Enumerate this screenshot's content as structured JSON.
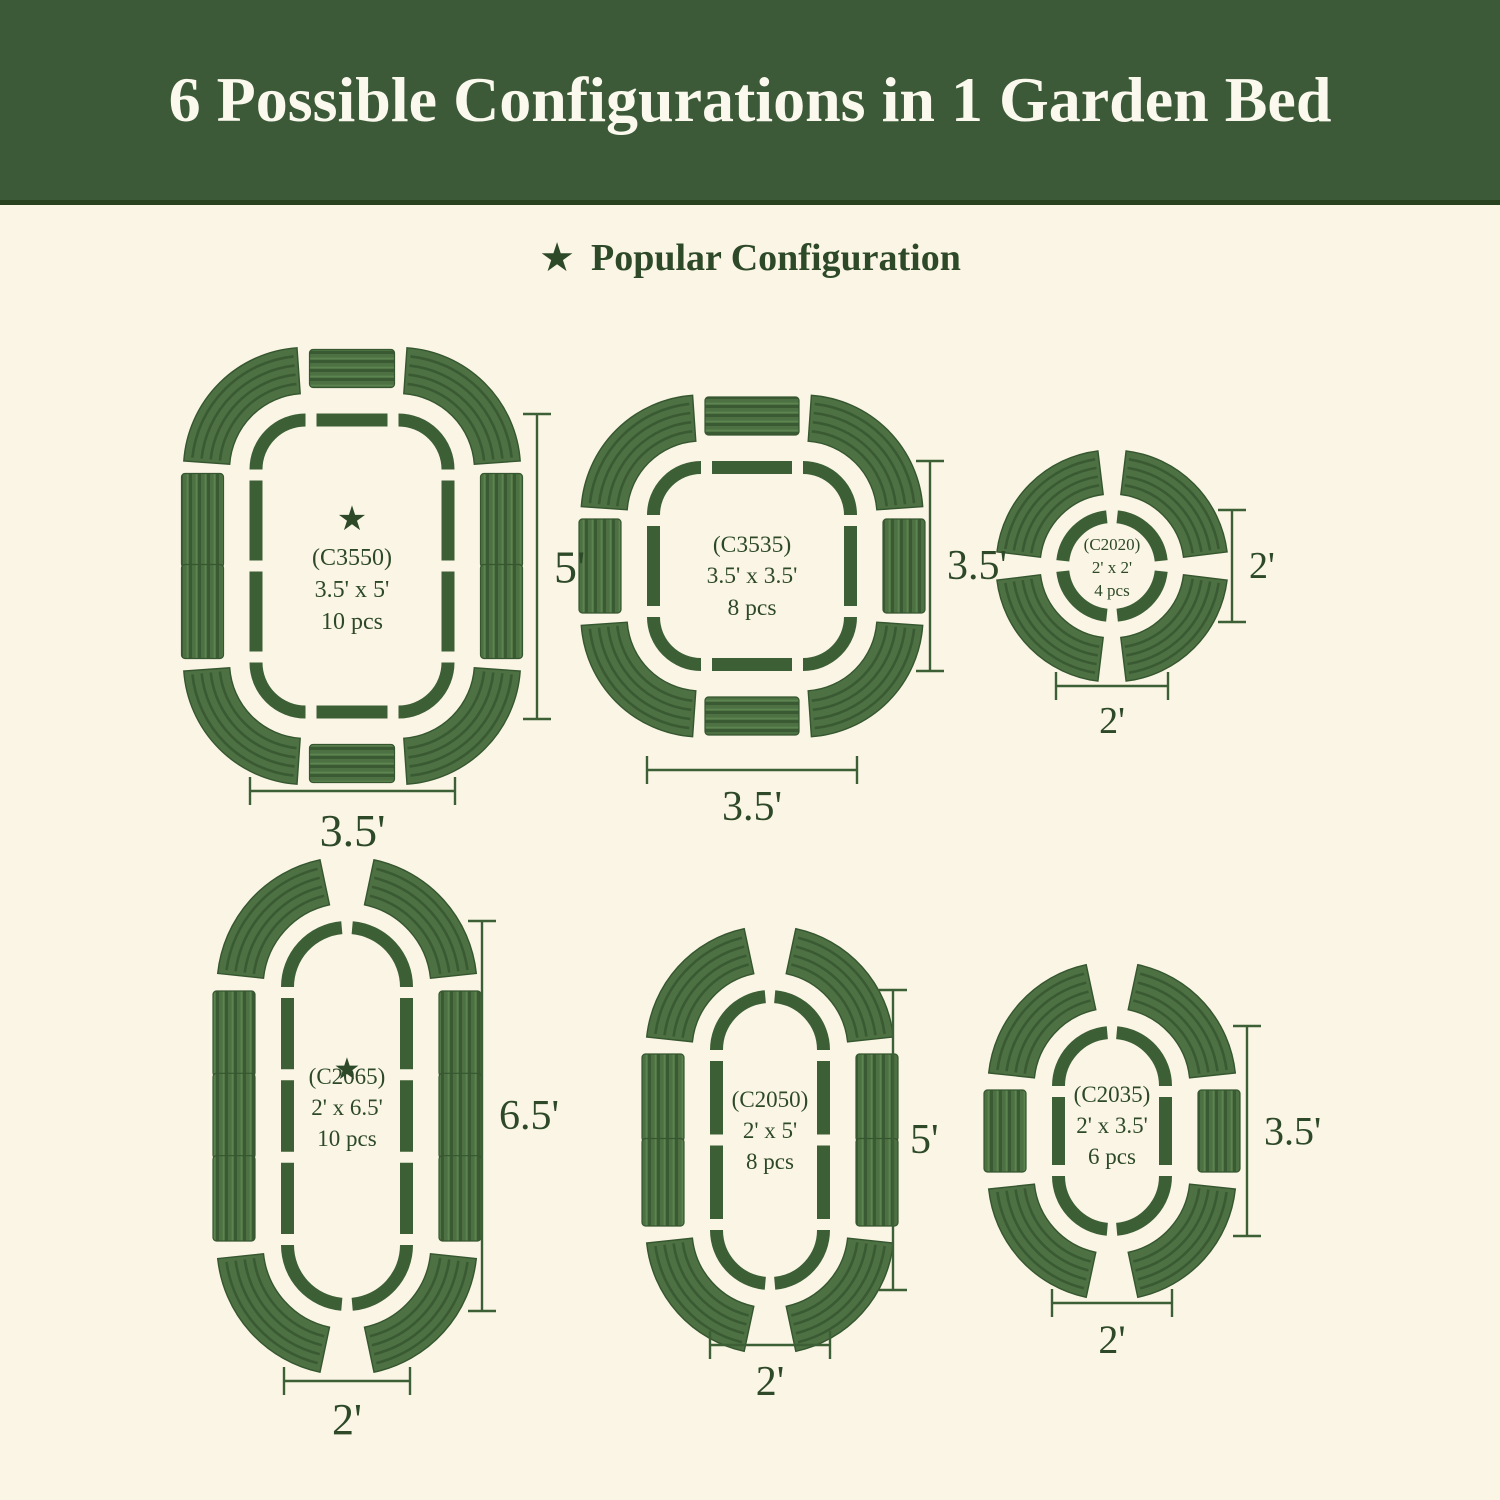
{
  "header": {
    "title": "6 Possible Configurations in 1 Garden Bed"
  },
  "legend": {
    "label": "Popular Configuration"
  },
  "icons": {
    "star": "★"
  },
  "colors": {
    "background": "#faf5e5",
    "header_background": "#3c5a38",
    "header_text": "#fbf9ee",
    "outline_green": "#3c5f35",
    "panel_green": "#4d7142",
    "panel_ridge_dark": "#3a5a33",
    "panel_ridge_light": "#5c8450",
    "text_green": "#2d4928"
  },
  "configs": [
    {
      "id": "c3550",
      "code": "(C3550)",
      "size": "3.5' x 5'",
      "pieces": "10 pcs",
      "popular": true,
      "width_label": "3.5'",
      "height_label": "5'"
    },
    {
      "id": "c3535",
      "code": "(C3535)",
      "size": "3.5' x 3.5'",
      "pieces": "8 pcs",
      "popular": false,
      "width_label": "3.5'",
      "height_label": "3.5'"
    },
    {
      "id": "c2020",
      "code": "(C2020)",
      "size": "2' x 2'",
      "pieces": "4 pcs",
      "popular": false,
      "width_label": "2'",
      "height_label": "2'"
    },
    {
      "id": "c2065",
      "code": "(C2065)",
      "size": "2' x 6.5'",
      "pieces": "10 pcs",
      "popular": true,
      "width_label": "2'",
      "height_label": "6.5'"
    },
    {
      "id": "c2050",
      "code": "(C2050)",
      "size": "2' x 5'",
      "pieces": "8 pcs",
      "popular": false,
      "width_label": "2'",
      "height_label": "5'"
    },
    {
      "id": "c2035",
      "code": "(C2035)",
      "size": "2' x 3.5'",
      "pieces": "6 pcs",
      "popular": false,
      "width_label": "2'",
      "height_label": "3.5'"
    }
  ]
}
